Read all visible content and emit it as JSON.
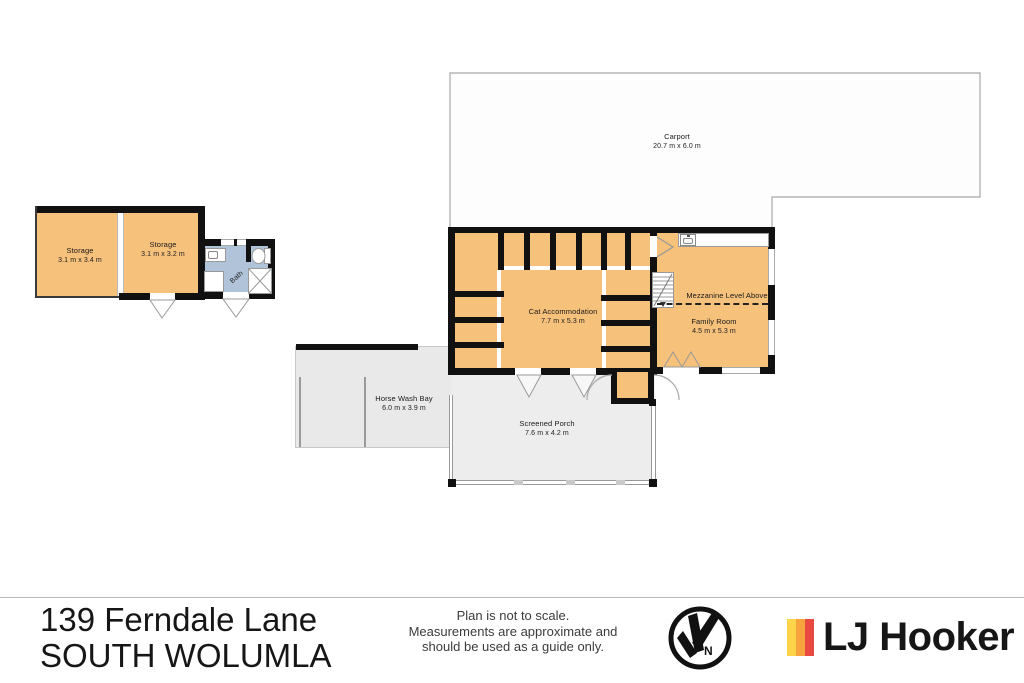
{
  "rooms": {
    "carport": {
      "name": "Carport",
      "dims": "20.7 m x 6.0 m"
    },
    "storage_a": {
      "name": "Storage",
      "dims": "3.1 m x 3.4 m"
    },
    "storage_b": {
      "name": "Storage",
      "dims": "3.1 m x 3.2 m"
    },
    "bath": {
      "name": "Bath"
    },
    "cat_accommodation": {
      "name": "Cat Accommodation",
      "dims": "7.7 m x 5.3 m"
    },
    "family_room": {
      "name": "Family Room",
      "dims": "4.5 m x 5.3 m"
    },
    "mezzanine_note": "Mezzanine Level Above",
    "horse_wash_bay": {
      "name": "Horse Wash Bay",
      "dims": "6.0 m x 3.9 m"
    },
    "screened_porch": {
      "name": "Screened Porch",
      "dims": "7.6 m x 4.2 m"
    }
  },
  "footer": {
    "address_line1": "139 Ferndale Lane",
    "address_line2": "SOUTH WOLUMLA",
    "disclaimer": [
      "Plan is not to scale.",
      "Measurements are approximate and",
      "should be used as a guide only."
    ],
    "compass_letter": "N",
    "brand": "LJ Hooker"
  },
  "colors": {
    "wall": "#111111",
    "room_fill": "#F6C17A",
    "bath_fill": "#B0C3D8",
    "porch_fill": "#EDEDED",
    "horse_bay_fill": "#E9E9E9",
    "carport_fill": "#FDFDFD",
    "brand_yellow": "#FFD44B",
    "brand_orange": "#F7A43C",
    "brand_red": "#E84A3F",
    "brand_text": "#161616"
  }
}
